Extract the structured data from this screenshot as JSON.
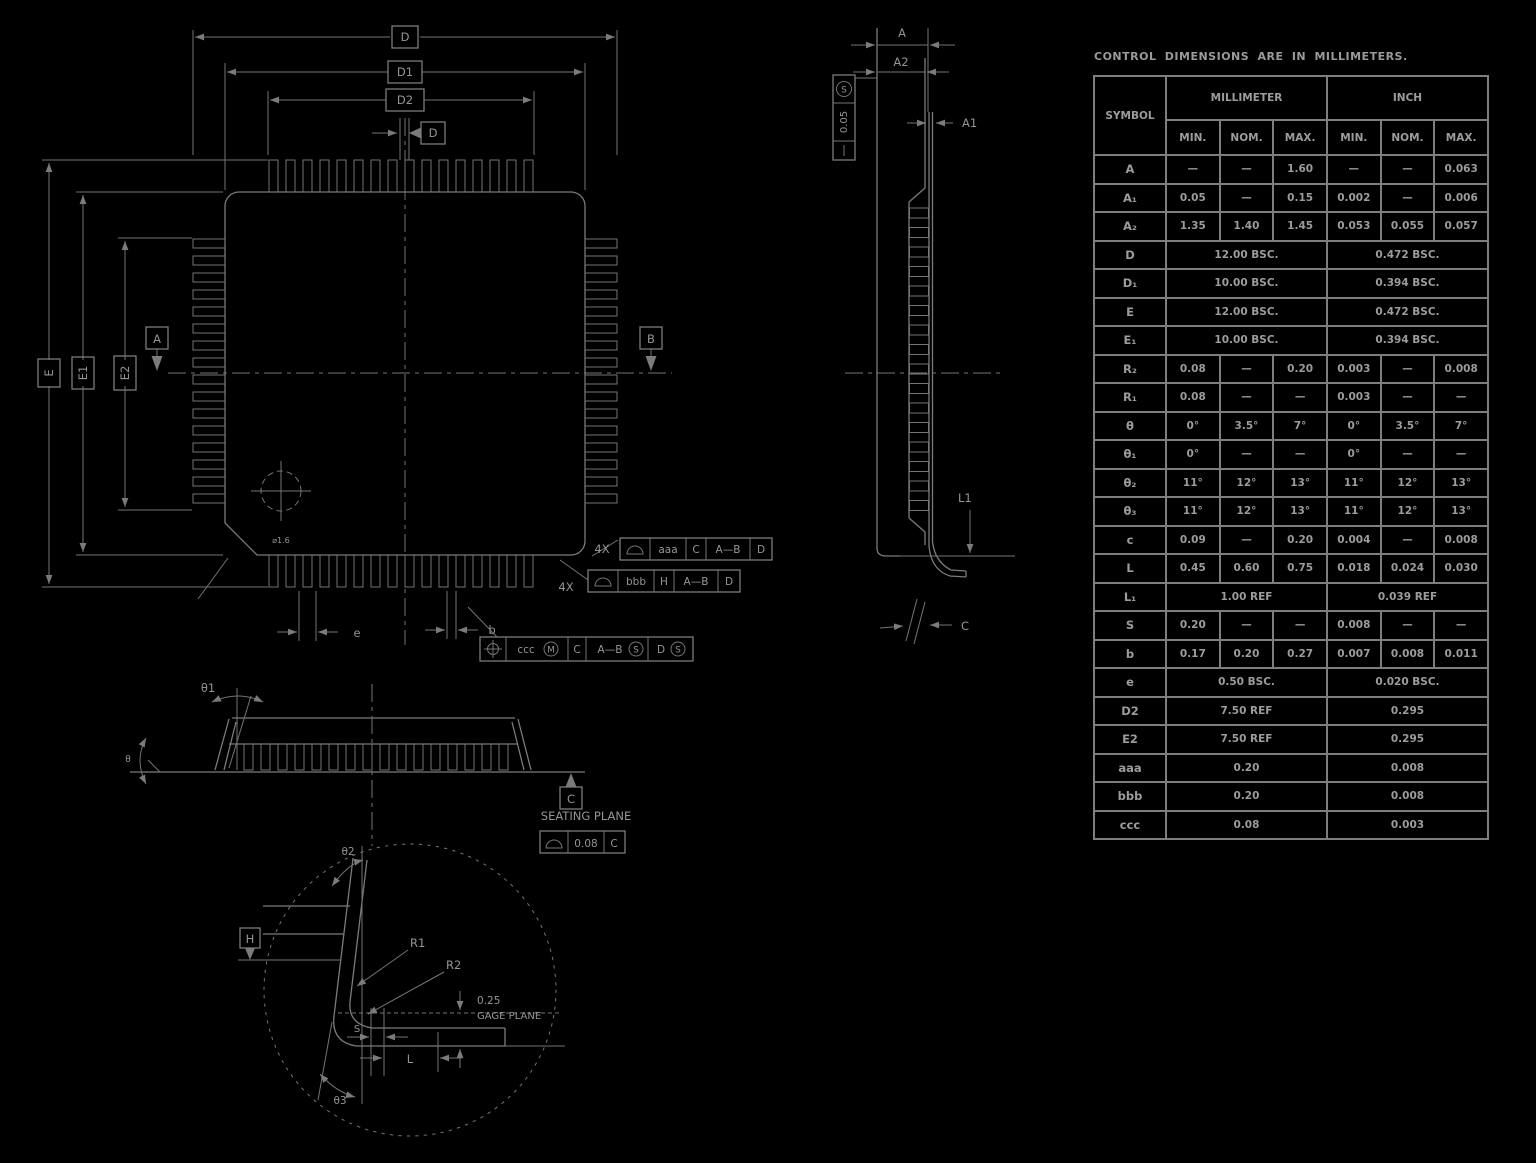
{
  "title": "CONTROL DIMENSIONS ARE IN MILLIMETERS.",
  "table": {
    "symbol_header": "SYMBOL",
    "group_headers": [
      "MILLIMETER",
      "INCH"
    ],
    "sub_headers": [
      "MIN.",
      "NOM.",
      "MAX.",
      "MIN.",
      "NOM.",
      "MAX."
    ],
    "rows": [
      {
        "symbol": "A",
        "mm": [
          "—",
          "—",
          "1.60"
        ],
        "inch": [
          "—",
          "—",
          "0.063"
        ]
      },
      {
        "symbol": "A₁",
        "mm": [
          "0.05",
          "—",
          "0.15"
        ],
        "inch": [
          "0.002",
          "—",
          "0.006"
        ]
      },
      {
        "symbol": "A₂",
        "mm": [
          "1.35",
          "1.40",
          "1.45"
        ],
        "inch": [
          "0.053",
          "0.055",
          "0.057"
        ]
      },
      {
        "symbol": "D",
        "mm_span": "12.00  BSC.",
        "inch_span": "0.472  BSC."
      },
      {
        "symbol": "D₁",
        "mm_span": "10.00  BSC.",
        "inch_span": "0.394  BSC."
      },
      {
        "symbol": "E",
        "mm_span": "12.00  BSC.",
        "inch_span": "0.472  BSC."
      },
      {
        "symbol": "E₁",
        "mm_span": "10.00  BSC.",
        "inch_span": "0.394  BSC."
      },
      {
        "symbol": "R₂",
        "mm": [
          "0.08",
          "—",
          "0.20"
        ],
        "inch": [
          "0.003",
          "—",
          "0.008"
        ]
      },
      {
        "symbol": "R₁",
        "mm": [
          "0.08",
          "—",
          "—"
        ],
        "inch": [
          "0.003",
          "—",
          "—"
        ]
      },
      {
        "symbol": "θ",
        "mm": [
          "0°",
          "3.5°",
          "7°"
        ],
        "inch": [
          "0°",
          "3.5°",
          "7°"
        ]
      },
      {
        "symbol": "θ₁",
        "mm": [
          "0°",
          "—",
          "—"
        ],
        "inch": [
          "0°",
          "—",
          "—"
        ]
      },
      {
        "symbol": "θ₂",
        "mm": [
          "11°",
          "12°",
          "13°"
        ],
        "inch": [
          "11°",
          "12°",
          "13°"
        ]
      },
      {
        "symbol": "θ₃",
        "mm": [
          "11°",
          "12°",
          "13°"
        ],
        "inch": [
          "11°",
          "12°",
          "13°"
        ]
      },
      {
        "symbol": "c",
        "mm": [
          "0.09",
          "—",
          "0.20"
        ],
        "inch": [
          "0.004",
          "—",
          "0.008"
        ]
      },
      {
        "symbol": "L",
        "mm": [
          "0.45",
          "0.60",
          "0.75"
        ],
        "inch": [
          "0.018",
          "0.024",
          "0.030"
        ]
      },
      {
        "symbol": "L₁",
        "mm_span": "1.00  REF",
        "inch_span": "0.039  REF"
      },
      {
        "symbol": "S",
        "mm": [
          "0.20",
          "—",
          "—"
        ],
        "inch": [
          "0.008",
          "—",
          "—"
        ]
      },
      {
        "symbol": "b",
        "mm": [
          "0.17",
          "0.20",
          "0.27"
        ],
        "inch": [
          "0.007",
          "0.008",
          "0.011"
        ]
      },
      {
        "symbol": "e",
        "mm_span": "0.50  BSC.",
        "inch_span": "0.020  BSC."
      },
      {
        "symbol": "D2",
        "mm_span": "7.50  REF",
        "inch_span": "0.295"
      },
      {
        "symbol": "E2",
        "mm_span": "7.50  REF",
        "inch_span": "0.295"
      },
      {
        "symbol": "aaa",
        "mm_span": "0.20",
        "inch_span": "0.008"
      },
      {
        "symbol": "bbb",
        "mm_span": "0.20",
        "inch_span": "0.008"
      },
      {
        "symbol": "ccc",
        "mm_span": "0.08",
        "inch_span": "0.003"
      }
    ]
  },
  "top_view": {
    "dim_d": "D",
    "dim_d1": "D1",
    "dim_d2": "D2",
    "dim_e": "E",
    "dim_e1": "E1",
    "dim_e2": "E2",
    "datum_a": "A",
    "datum_b": "B",
    "datum_d": "D",
    "pin1_note": "⌀1.6",
    "dim_e_pitch": "e",
    "dim_b": "b",
    "fcf_aaa": {
      "prefix": "4X",
      "tol": "aaa",
      "d1": "C",
      "d2": "A—B",
      "d3": "D"
    },
    "fcf_bbb": {
      "prefix": "4X",
      "tol": "bbb",
      "d1": "H",
      "d2": "A—B",
      "d3": "D"
    },
    "fcf_pos": {
      "tol": "ccc",
      "mod1": "M",
      "d1": "C",
      "d2": "A—B",
      "mod2": "S",
      "d3": "D",
      "mod3": "S"
    }
  },
  "side_view": {
    "dim_a": "A",
    "dim_a2": "A2",
    "dim_a1": "A1",
    "dim_l1": "L1",
    "dim_c": "C",
    "fcf": {
      "sym": "S",
      "value": "0.05",
      "dash": "—"
    }
  },
  "bottom_view": {
    "theta1": "θ1",
    "theta": "θ",
    "seating_plane": "SEATING  PLANE",
    "fcf_value": "0.08",
    "fcf_datum": "C",
    "datum_c": "C"
  },
  "detail_view": {
    "r1": "R1",
    "r2": "R2",
    "offset": "0.25",
    "gage_plane": "GAGE  PLANE",
    "dim_s": "S",
    "dim_l": "L",
    "theta2": "θ2",
    "theta3": "θ3",
    "datum_h": "H"
  }
}
